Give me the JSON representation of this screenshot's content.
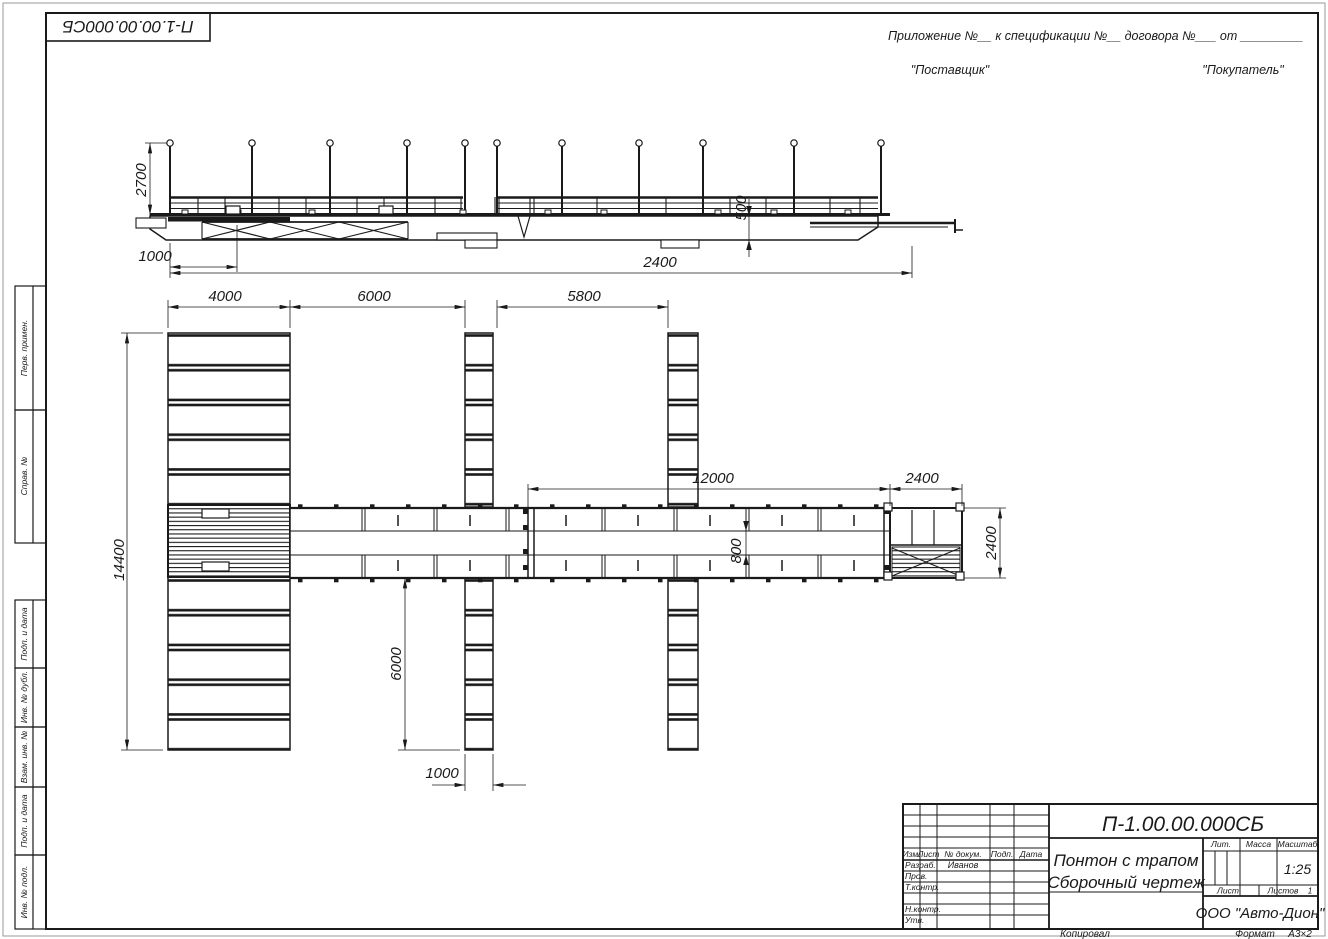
{
  "sheet": {
    "corner_doc_number": "П-1.00.00.000СБ",
    "appendix_line": "Приложение №__      к спецификации №__     договора №___    от _________",
    "supplier": "\"Поставщик\"",
    "buyer": "\"Покупатель\"",
    "footer": {
      "copied": "Копировал",
      "format_label": "Формат",
      "format_value": "А3×2"
    }
  },
  "margin_labels": {
    "perv_primen": "Перв. примен.",
    "sprav_no": "Справ. №",
    "podp_data_1": "Подп. и дата",
    "inv_dubl": "Инв. № дубл.",
    "vzam_inv": "Взам. инв. №",
    "podp_data_2": "Подп. и дата",
    "inv_podl": "Инв. № подл."
  },
  "dimensions": {
    "pole_height": "2700",
    "ramp_offset": "1000",
    "overall_length": "2400",
    "hull_depth": "500",
    "pontoon_width": "4000",
    "bay_gap_1": "6000",
    "bay_gap_2": "5800",
    "walkway_length": "12000",
    "platform_width": "2400",
    "pontoon_length": "14400",
    "walkway_gap": "800",
    "finger_length": "6000",
    "finger_width": "1000",
    "platform_height": "2400"
  },
  "title_block": {
    "doc_number": "П-1.00.00.000СБ",
    "title_line1": "Понтон с трапом",
    "title_line2": "Сборочный чертеж",
    "company": "ООО \"Авто-Дион\"",
    "scale_value": "1:25",
    "labels": {
      "izm": "Изм.",
      "list": "Лист",
      "doc": "№ докум.",
      "podp": "Подп.",
      "data": "Дата",
      "lit": "Лит.",
      "massa": "Масса",
      "masshtab": "Масштаб",
      "list2": "Лист",
      "listov": "Листов",
      "listov_value": "1"
    },
    "rows": {
      "razrab": "Разраб.",
      "prov": "Пров.",
      "tkontr": "Т.контр.",
      "nkontr": "Н.контр.",
      "utv": "Утв.",
      "razrab_name": "Иванов"
    }
  }
}
